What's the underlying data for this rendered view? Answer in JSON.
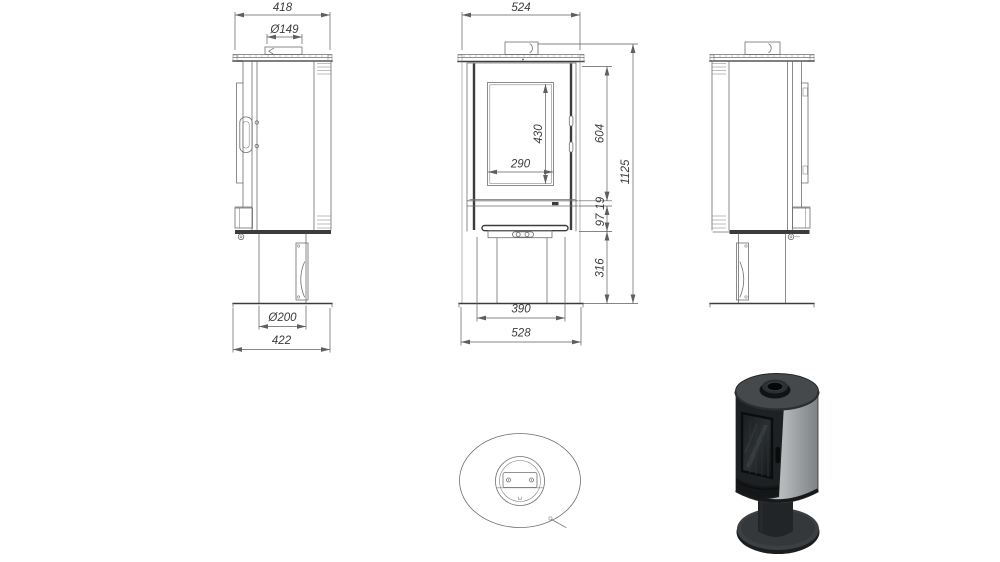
{
  "drawing_type": "stove technical dimension drawing",
  "dimensions": {
    "side_left": {
      "overall_width": "418",
      "flue_diameter": "Ø149",
      "pedestal_diameter": "Ø200",
      "base_width": "422"
    },
    "front": {
      "overall_width": "524",
      "glass_height": "430",
      "glass_width": "290",
      "upper_body_height": "604",
      "overall_height": "1125",
      "trim_height": "19",
      "plinth_height": "97",
      "pedestal_height": "316",
      "lower_body_width": "390",
      "base_width": "528"
    }
  },
  "colors": {
    "c-bg": "#ffffff",
    "c-line": "#6f6f6f",
    "c-line-dark": "#3c3c3c",
    "c-dim": "#5f5f5f",
    "c-text": "#3b3b3b",
    "render-side-panel": "#b6babb",
    "render-front-door": "#1e2123",
    "render-top-plate": "#45494c",
    "render-base": "#3a3e41"
  }
}
